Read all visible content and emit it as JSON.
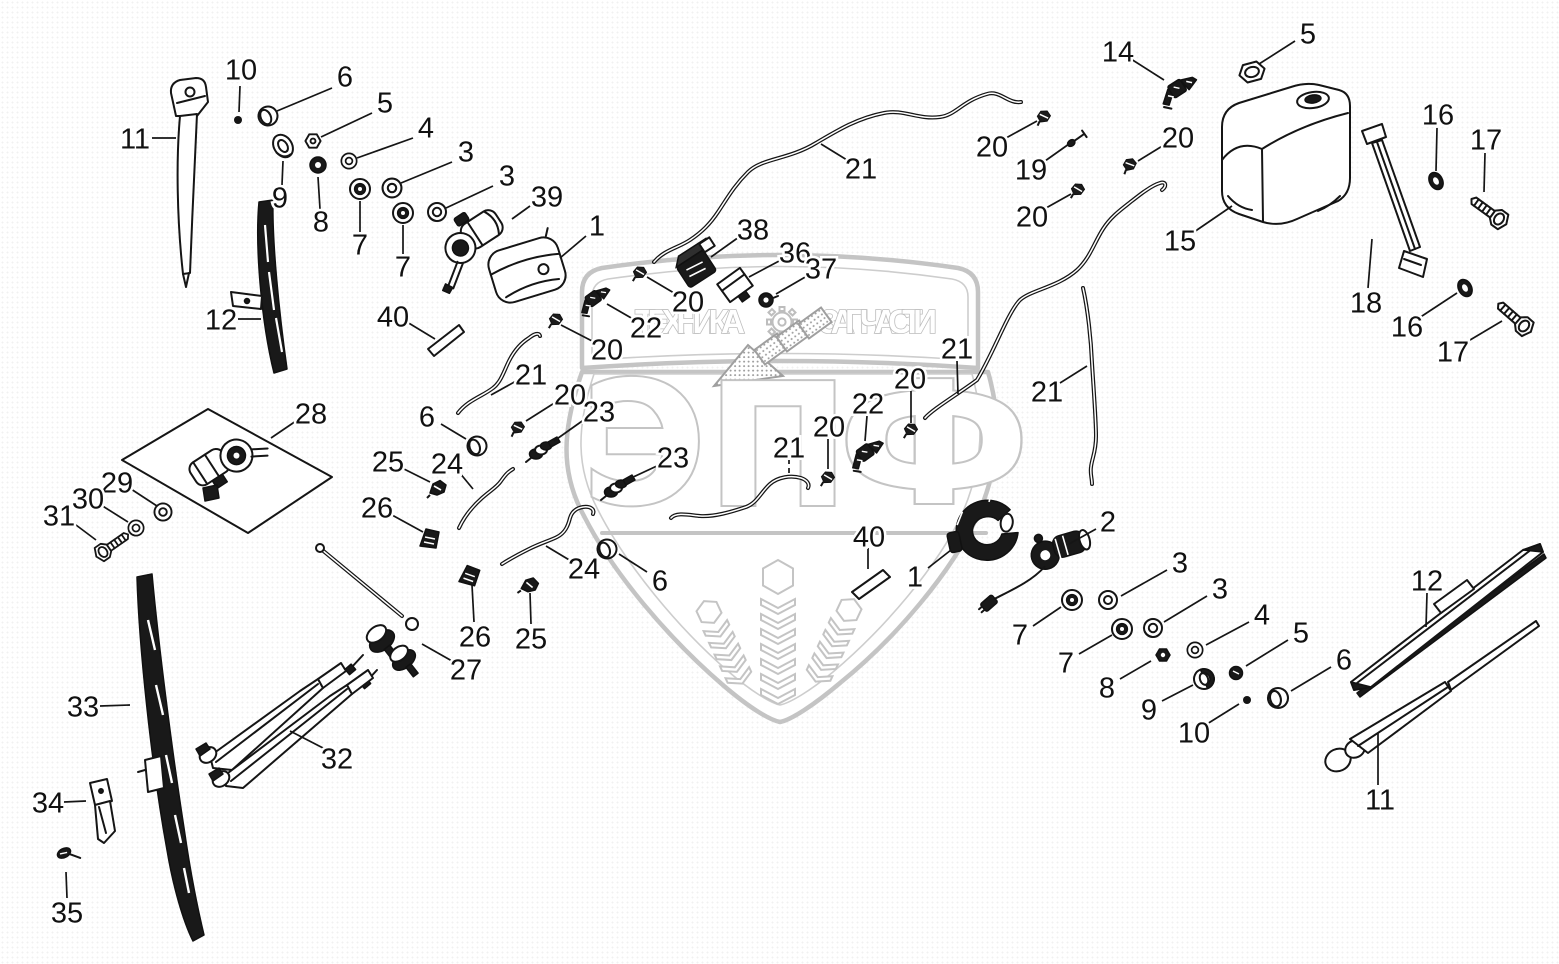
{
  "watermark": {
    "band_left": "ТЕХНИКА",
    "band_right": "ЗАПЧАСТИ",
    "letters": [
      "Э",
      "П",
      "Ф"
    ],
    "color": "#c4c4c4"
  },
  "diagram": {
    "line_color": "#151515",
    "part_numbers_shown": [
      1,
      2,
      3,
      4,
      5,
      6,
      7,
      8,
      9,
      10,
      11,
      12,
      14,
      15,
      16,
      17,
      18,
      19,
      20,
      21,
      22,
      23,
      24,
      25,
      26,
      27,
      28,
      29,
      30,
      31,
      32,
      33,
      34,
      35,
      36,
      37,
      38,
      39,
      40
    ],
    "callouts": [
      [
        "10",
        241,
        69,
        240,
        86,
        239,
        112,
        0
      ],
      [
        "6",
        345,
        76,
        332,
        88,
        277,
        111,
        0
      ],
      [
        "5",
        385,
        102,
        372,
        113,
        321,
        137,
        0
      ],
      [
        "4",
        426,
        127,
        413,
        138,
        357,
        158,
        0
      ],
      [
        "3",
        466,
        151,
        452,
        162,
        401,
        183,
        0
      ],
      [
        "3",
        507,
        175,
        493,
        186,
        446,
        208,
        0
      ],
      [
        "39",
        547,
        196,
        530,
        206,
        512,
        219,
        0
      ],
      [
        "1",
        597,
        225,
        586,
        236,
        560,
        258,
        0
      ],
      [
        "11",
        135,
        138,
        152,
        138,
        176,
        138,
        0
      ],
      [
        "12",
        221,
        319,
        238,
        319,
        261,
        319,
        0
      ],
      [
        "9",
        280,
        197,
        282,
        185,
        283,
        161,
        0
      ],
      [
        "8",
        321,
        221,
        320,
        209,
        318,
        177,
        0
      ],
      [
        "7",
        360,
        244,
        360,
        232,
        360,
        201,
        0
      ],
      [
        "7",
        403,
        266,
        403,
        254,
        403,
        225,
        0
      ],
      [
        "40",
        393,
        316,
        407,
        322,
        435,
        339,
        0
      ],
      [
        "28",
        311,
        413,
        296,
        421,
        271,
        438,
        0
      ],
      [
        "29",
        117,
        482,
        131,
        489,
        157,
        506,
        0
      ],
      [
        "30",
        88,
        498,
        101,
        505,
        128,
        522,
        0
      ],
      [
        "31",
        59,
        515,
        72,
        522,
        96,
        540,
        0
      ],
      [
        "33",
        83,
        706,
        100,
        706,
        130,
        705,
        0
      ],
      [
        "34",
        48,
        802,
        64,
        802,
        86,
        801,
        0
      ],
      [
        "35",
        67,
        912,
        67,
        898,
        66,
        872,
        0
      ],
      [
        "32",
        337,
        758,
        325,
        749,
        290,
        731,
        0
      ],
      [
        "27",
        466,
        669,
        452,
        661,
        422,
        644,
        0
      ],
      [
        "26",
        377,
        507,
        392,
        515,
        423,
        532,
        0
      ],
      [
        "25",
        388,
        461,
        402,
        468,
        430,
        482,
        0
      ],
      [
        "24",
        447,
        463,
        459,
        472,
        473,
        489,
        0
      ],
      [
        "26",
        475,
        636,
        474,
        622,
        472,
        585,
        0
      ],
      [
        "25",
        531,
        638,
        531,
        624,
        530,
        593,
        0
      ],
      [
        "24",
        584,
        568,
        571,
        561,
        546,
        546,
        0
      ],
      [
        "6",
        427,
        416,
        441,
        424,
        466,
        439,
        0
      ],
      [
        "23",
        599,
        411,
        585,
        419,
        554,
        441,
        0
      ],
      [
        "20",
        570,
        394,
        556,
        402,
        526,
        421,
        0
      ],
      [
        "21",
        531,
        374,
        518,
        380,
        491,
        395,
        0
      ],
      [
        "6",
        660,
        580,
        647,
        572,
        619,
        554,
        0
      ],
      [
        "23",
        673,
        457,
        659,
        465,
        631,
        478,
        0
      ],
      [
        "20",
        607,
        349,
        594,
        342,
        561,
        325,
        0
      ],
      [
        "22",
        646,
        327,
        633,
        319,
        607,
        304,
        0
      ],
      [
        "20",
        688,
        301,
        674,
        293,
        647,
        277,
        0
      ],
      [
        "38",
        753,
        229,
        739,
        237,
        711,
        257,
        0
      ],
      [
        "36",
        795,
        252,
        781,
        260,
        749,
        277,
        0
      ],
      [
        "37",
        821,
        268,
        807,
        276,
        776,
        294,
        0
      ],
      [
        "21",
        861,
        168,
        847,
        160,
        821,
        144,
        0
      ],
      [
        "20",
        992,
        146,
        1006,
        138,
        1037,
        121,
        0
      ],
      [
        "19",
        1031,
        169,
        1045,
        161,
        1069,
        144,
        0
      ],
      [
        "20",
        1032,
        216,
        1046,
        208,
        1071,
        194,
        0
      ],
      [
        "20",
        1178,
        137,
        1164,
        145,
        1138,
        161,
        0
      ],
      [
        "14",
        1118,
        51,
        1131,
        59,
        1164,
        80,
        0
      ],
      [
        "5",
        1308,
        33,
        1295,
        41,
        1259,
        64,
        0
      ],
      [
        "15",
        1180,
        240,
        1194,
        232,
        1232,
        206,
        0
      ],
      [
        "16",
        1438,
        114,
        1437,
        128,
        1436,
        171,
        0
      ],
      [
        "17",
        1486,
        139,
        1485,
        153,
        1484,
        192,
        0
      ],
      [
        "18",
        1366,
        302,
        1368,
        288,
        1372,
        239,
        0
      ],
      [
        "16",
        1407,
        326,
        1419,
        318,
        1457,
        293,
        0
      ],
      [
        "17",
        1453,
        351,
        1465,
        343,
        1502,
        321,
        0
      ],
      [
        "21",
        957,
        348,
        957,
        361,
        958,
        394,
        0
      ],
      [
        "20",
        910,
        378,
        911,
        391,
        911,
        423,
        0
      ],
      [
        "22",
        868,
        403,
        867,
        416,
        865,
        441,
        0
      ],
      [
        "20",
        829,
        426,
        828,
        438,
        828,
        469,
        0
      ],
      [
        "21",
        1047,
        391,
        1060,
        383,
        1087,
        366,
        0
      ],
      [
        "21",
        789,
        447,
        789,
        459,
        789,
        477,
        1
      ],
      [
        "40",
        869,
        536,
        868,
        548,
        868,
        569,
        0
      ],
      [
        "1",
        915,
        576,
        928,
        568,
        951,
        550,
        0
      ],
      [
        "2",
        1108,
        521,
        1096,
        529,
        1069,
        544,
        0
      ],
      [
        "7",
        1020,
        634,
        1033,
        626,
        1061,
        607,
        0
      ],
      [
        "3",
        1180,
        562,
        1167,
        570,
        1121,
        596,
        0
      ],
      [
        "7",
        1066,
        662,
        1079,
        654,
        1112,
        635,
        0
      ],
      [
        "3",
        1220,
        588,
        1207,
        596,
        1164,
        622,
        0
      ],
      [
        "8",
        1107,
        687,
        1120,
        679,
        1151,
        661,
        0
      ],
      [
        "4",
        1262,
        614,
        1249,
        622,
        1206,
        645,
        0
      ],
      [
        "9",
        1149,
        709,
        1162,
        701,
        1193,
        685,
        0
      ],
      [
        "5",
        1301,
        632,
        1288,
        640,
        1246,
        666,
        0
      ],
      [
        "10",
        1194,
        732,
        1207,
        724,
        1239,
        704,
        0
      ],
      [
        "6",
        1344,
        659,
        1331,
        667,
        1291,
        691,
        0
      ],
      [
        "12",
        1427,
        580,
        1427,
        593,
        1426,
        627,
        0
      ],
      [
        "11",
        1380,
        799,
        1378,
        785,
        1378,
        733,
        0
      ]
    ]
  }
}
